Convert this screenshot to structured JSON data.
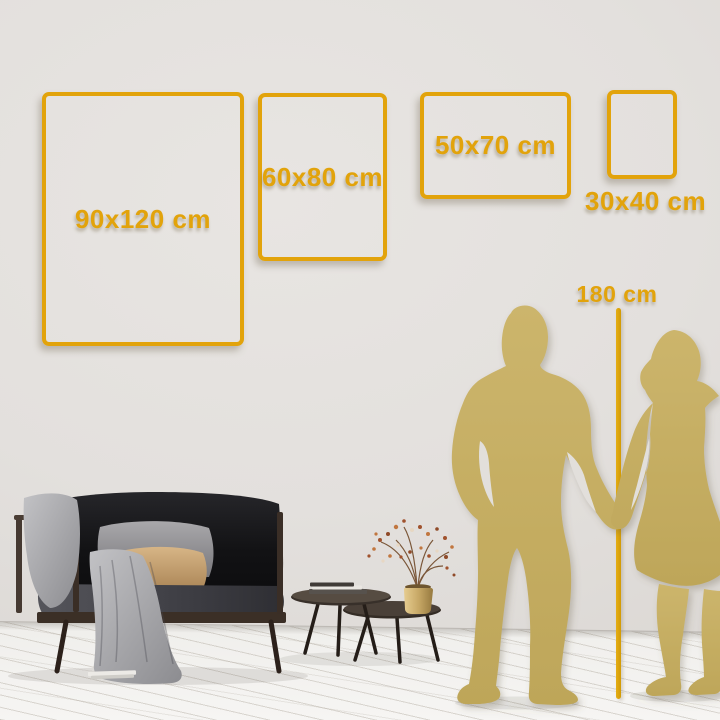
{
  "size_guide": {
    "frames": [
      {
        "size": "90x120",
        "label": "90x120 cm",
        "orientation": "portrait"
      },
      {
        "size": "60x80",
        "label": "60x80 cm",
        "orientation": "portrait"
      },
      {
        "size": "50x70",
        "label": "50x70 cm",
        "orientation": "landscape"
      },
      {
        "size": "30x40",
        "label": "30x40 cm",
        "orientation": "portrait"
      }
    ],
    "height_marker": {
      "label": "180 cm"
    }
  },
  "colors": {
    "accent_gold": "#E2A30B",
    "silhouette_gold": "#C7B064",
    "wall": "#E3E0DD",
    "floor": "#F4F3F1"
  },
  "scene_objects": [
    "sofa",
    "throw-blanket",
    "gray-pillow",
    "tan-pillow",
    "nesting-coffee-tables",
    "books",
    "brass-vase-with-dried-flowers",
    "man-silhouette",
    "woman-silhouette",
    "height-ruler"
  ]
}
